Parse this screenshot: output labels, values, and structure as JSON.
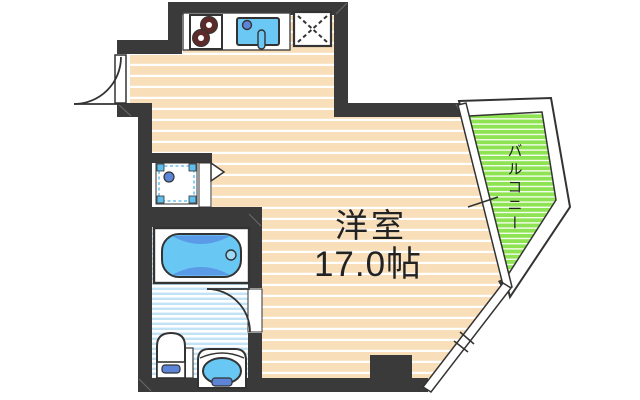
{
  "plan": {
    "type": "floor-plan",
    "rooms": {
      "main": {
        "name": "洋室",
        "size": "17.0帖"
      },
      "balcony": {
        "name": "バルコニー"
      }
    },
    "fixtures": [
      {
        "id": "stove-burners-icon",
        "meaning": "2-burner gas stove"
      },
      {
        "id": "kitchen-sink-icon",
        "meaning": "kitchen sink with faucet"
      },
      {
        "id": "refrigerator-space-icon",
        "meaning": "refrigerator space (dashed X square)"
      },
      {
        "id": "washing-machine-space-icon",
        "meaning": "washing machine pan"
      },
      {
        "id": "bathtub-icon",
        "meaning": "bathtub"
      },
      {
        "id": "washbasin-icon",
        "meaning": "washbasin"
      },
      {
        "id": "toilet-icon",
        "meaning": "toilet"
      },
      {
        "id": "entrance-door-icon",
        "meaning": "entrance door swing arc"
      },
      {
        "id": "bathroom-door-icon",
        "meaning": "bathroom door swing arc"
      },
      {
        "id": "closet-door-icon",
        "meaning": "door direction triangle"
      },
      {
        "id": "balcony-sliding-door-icon",
        "meaning": "sliding glass door to balcony"
      },
      {
        "id": "corner-window-icon",
        "meaning": "diagonal corner window"
      },
      {
        "id": "pillar",
        "meaning": "structural pillar"
      }
    ],
    "colors": {
      "wall": "#3A3A3A",
      "floor": "#F8DFBA",
      "floor_stripe": "#FFFFFF",
      "balcony": "#8DE352",
      "bath_stripe": "#C2E2F5",
      "water": "#6BC8F4",
      "water_dark": "#5A9AE6",
      "fixture_accent": "#5C85D8",
      "corner_blue": "#5FBEEA",
      "burner": "#5D2A2A",
      "outline": "#333333",
      "text": "#222222"
    }
  }
}
